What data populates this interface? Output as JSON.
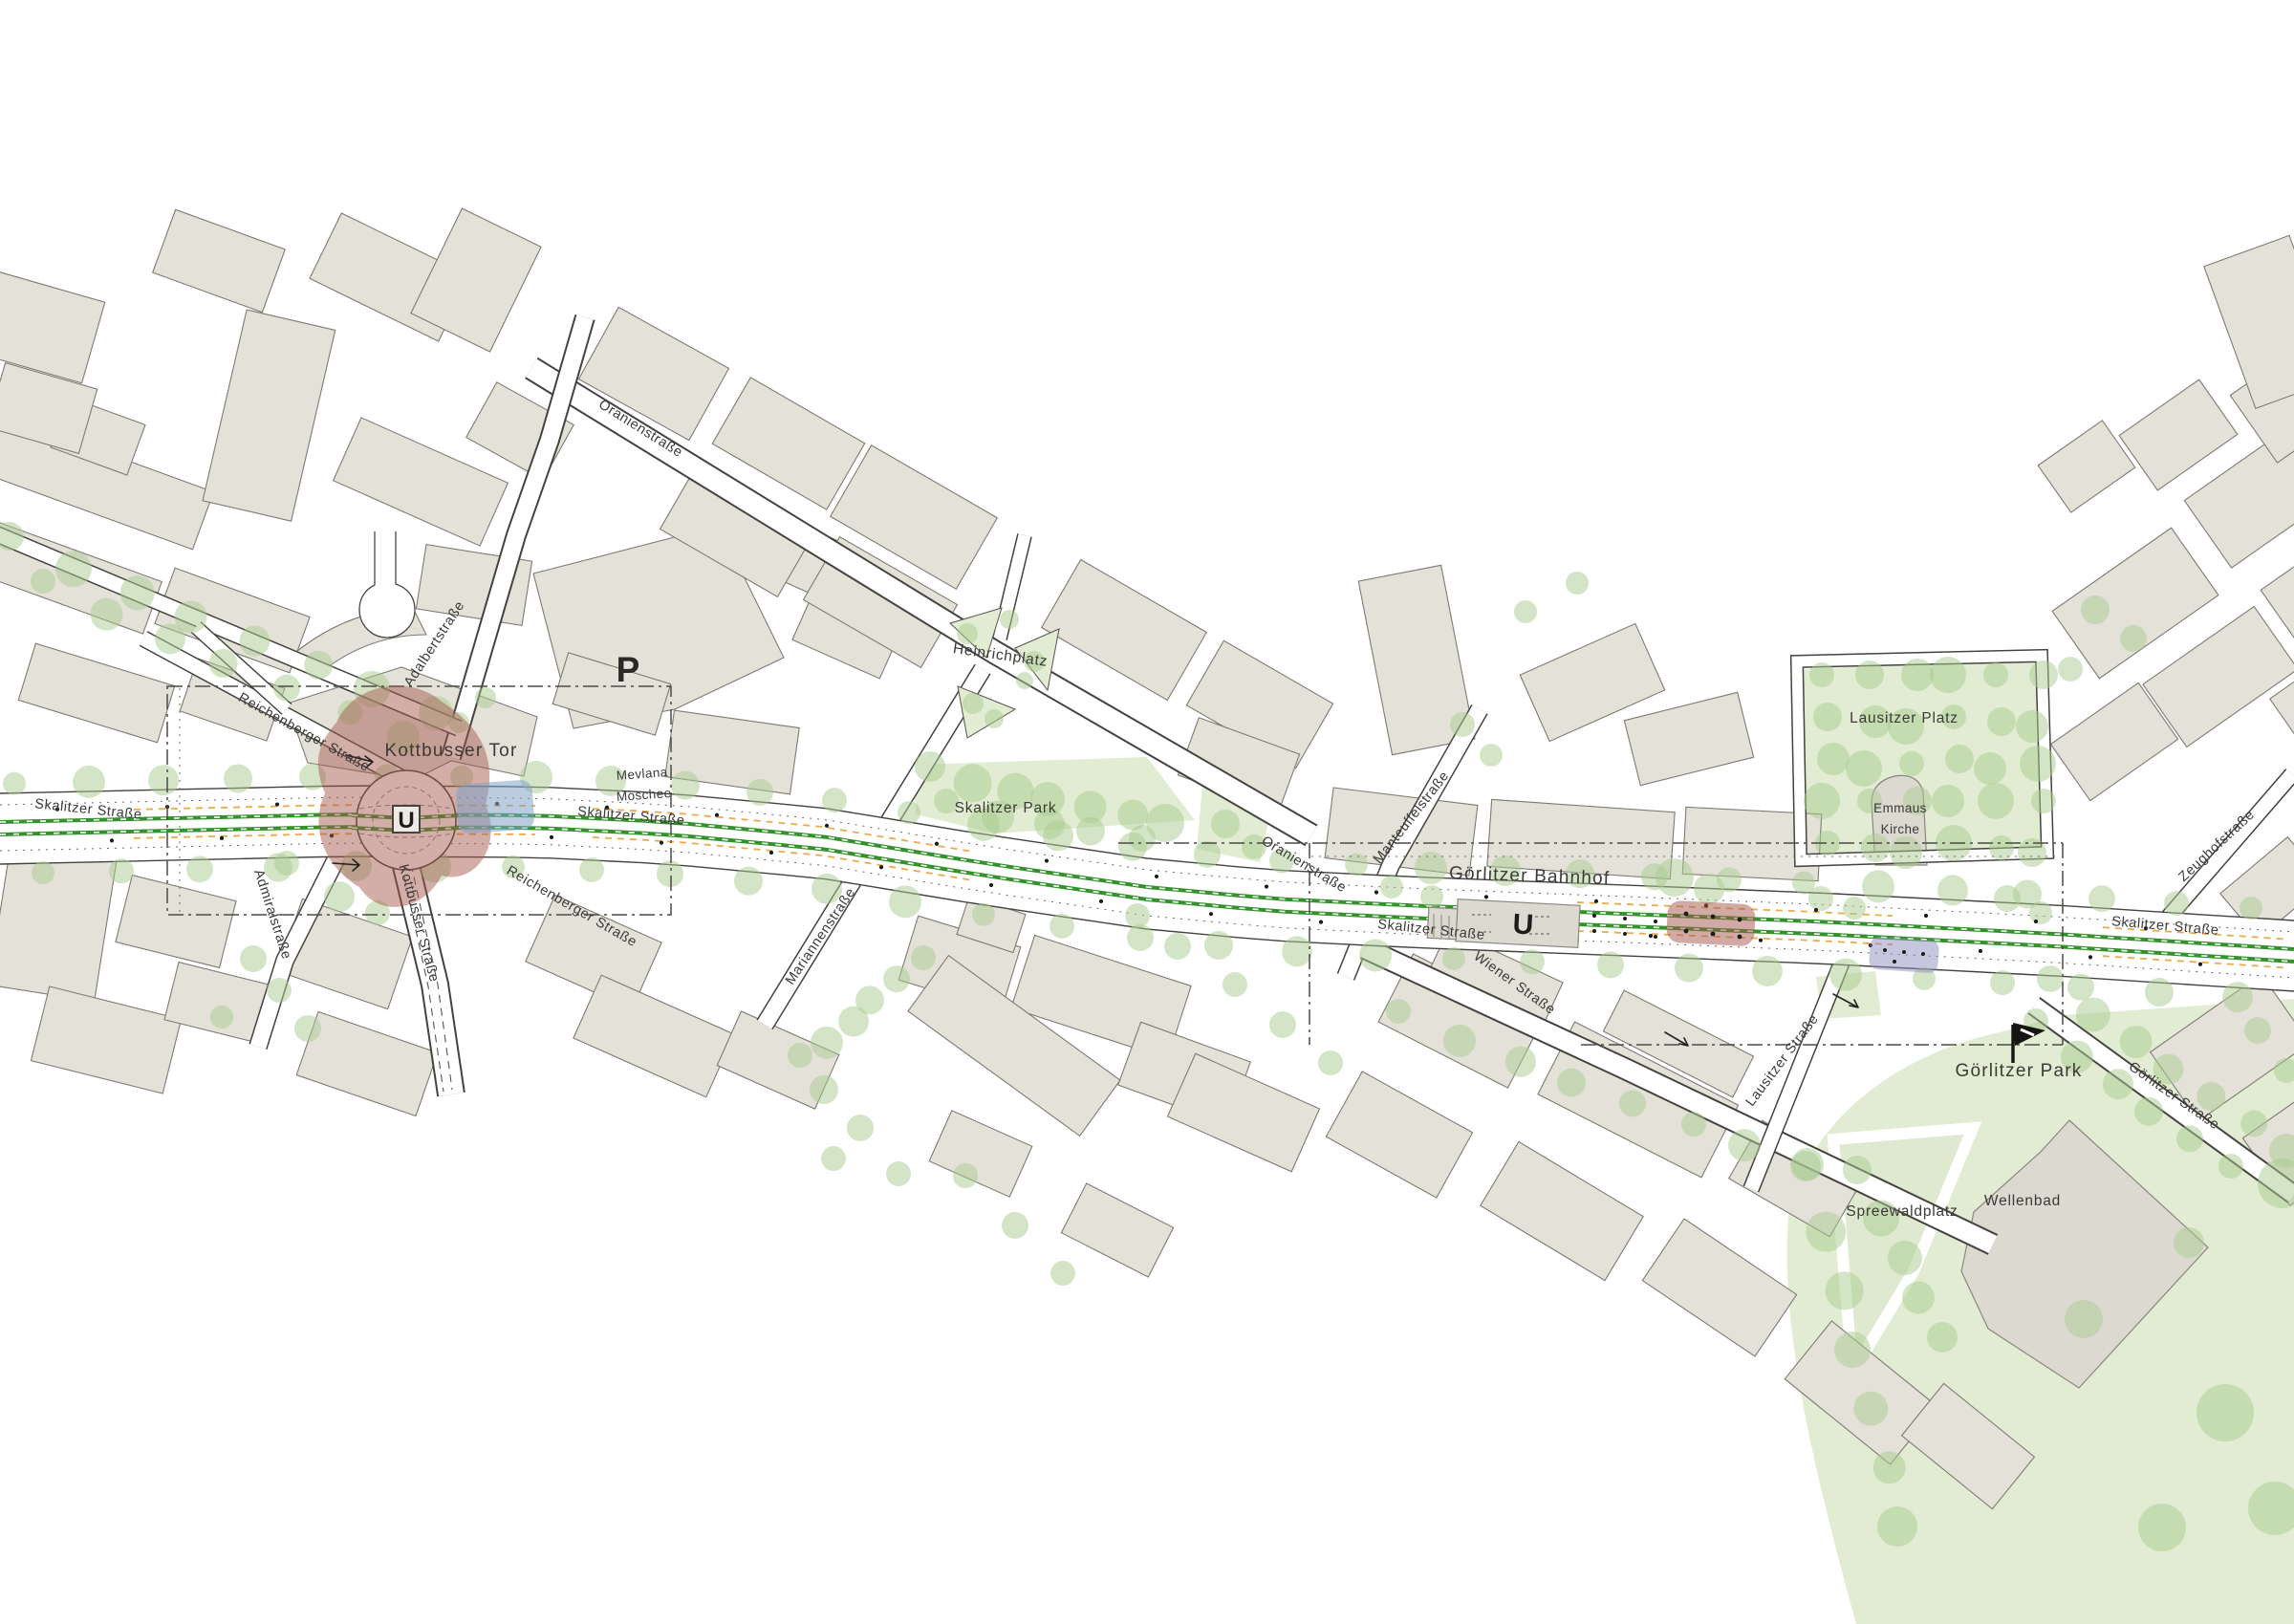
{
  "stations": {
    "kottbusser_tor": {
      "name": "Kottbusser Tor",
      "symbol": "U"
    },
    "goerlitzer_bahnhof": {
      "name": "Görlitzer Bahnhof",
      "symbol": "U"
    }
  },
  "streets": {
    "skalitzer": "Skalitzer Straße",
    "oranien": "Oranienstraße",
    "adalbert": "Adalbertstraße",
    "reichenberger": "Reichenberger Straße",
    "kottbusser": "Kottbusser Straße",
    "admiral": "Admiralstraße",
    "mariannen": "Mariannenstraße",
    "manteuffel": "Manteuffelstraße",
    "wiener": "Wiener Straße",
    "lausitzer": "Lausitzer Straße",
    "zeughof": "Zeughofstraße",
    "goerlitzer": "Görlitzer Straße"
  },
  "places": {
    "heinrichplatz": "Heinrichplatz",
    "skalitzer_park": "Skalitzer Park",
    "lausitzer_platz": "Lausitzer Platz",
    "emmaus_kirche": {
      "line1": "Emmaus",
      "line2": "Kirche"
    },
    "mevlana_moschee": {
      "line1": "Mevlana",
      "line2": "Moschee"
    },
    "goerlitzer_park": "Görlitzer Park",
    "spreewaldplatz": "Spreewaldplatz",
    "wellenbad": "Wellenbad"
  },
  "icons": {
    "parking_label": "P",
    "flag_icon": "park-entrance-flag"
  },
  "colors": {
    "building": "#e4e1d8",
    "park_green": "#e1ecd3",
    "tree_green": "#a9cc8f",
    "route_green": "#33922b",
    "highlight_red": "#a3564c",
    "highlight_blue": "#7fa2c6",
    "highlight_purple": "#8f8dc0",
    "parking_orange": "#ecaa4e"
  }
}
